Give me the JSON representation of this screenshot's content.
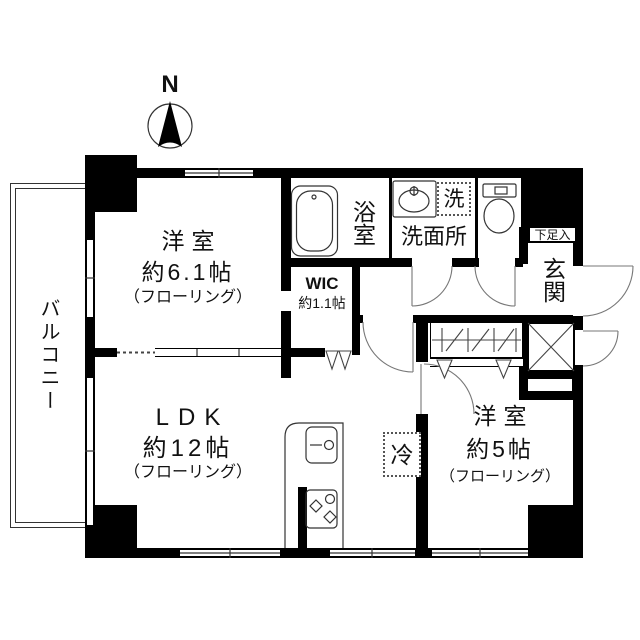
{
  "compass": {
    "label": "N"
  },
  "rooms": {
    "balcony": {
      "label": "バルコニー"
    },
    "bedroom_61": {
      "name": "洋室",
      "size": "約6.1帖",
      "floor": "（フローリング）"
    },
    "bath": {
      "label": "浴室"
    },
    "washroom": {
      "label": "洗面所"
    },
    "washer": {
      "label": "洗"
    },
    "wic": {
      "label": "WIC",
      "size": "約1.1帖"
    },
    "entrance": {
      "label": "玄関",
      "shoebox": "下足入"
    },
    "ldk": {
      "name": "LDK",
      "size": "約12帖",
      "floor": "（フローリング）"
    },
    "fridge": {
      "label": "冷"
    },
    "bedroom_5": {
      "name": "洋室",
      "size": "約5帖",
      "floor": "（フローリング）"
    }
  },
  "colors": {
    "wall": "#000000",
    "line": "#1a1a1a",
    "bg": "#ffffff"
  }
}
